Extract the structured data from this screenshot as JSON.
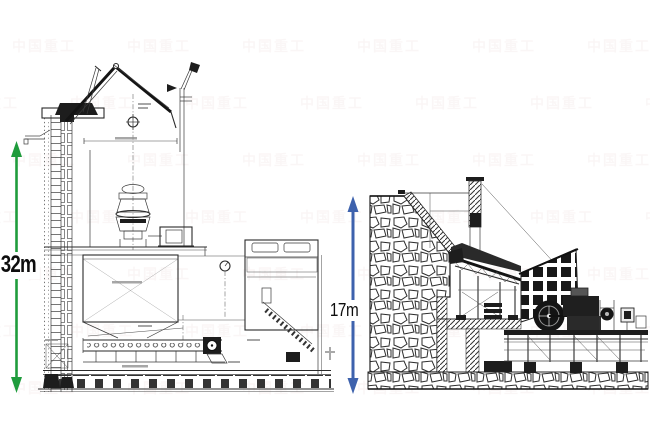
{
  "canvas": {
    "width": 650,
    "height": 430,
    "background": "#ffffff"
  },
  "watermark": {
    "text": "中国重工",
    "color": "#b06a6a",
    "opacity": 0.05
  },
  "left_drawing": {
    "dimension_label": "32m",
    "arrow_color": "#1f9c3c"
  },
  "right_drawing": {
    "dimension_label": "17m",
    "arrow_color": "#3e62ad"
  }
}
